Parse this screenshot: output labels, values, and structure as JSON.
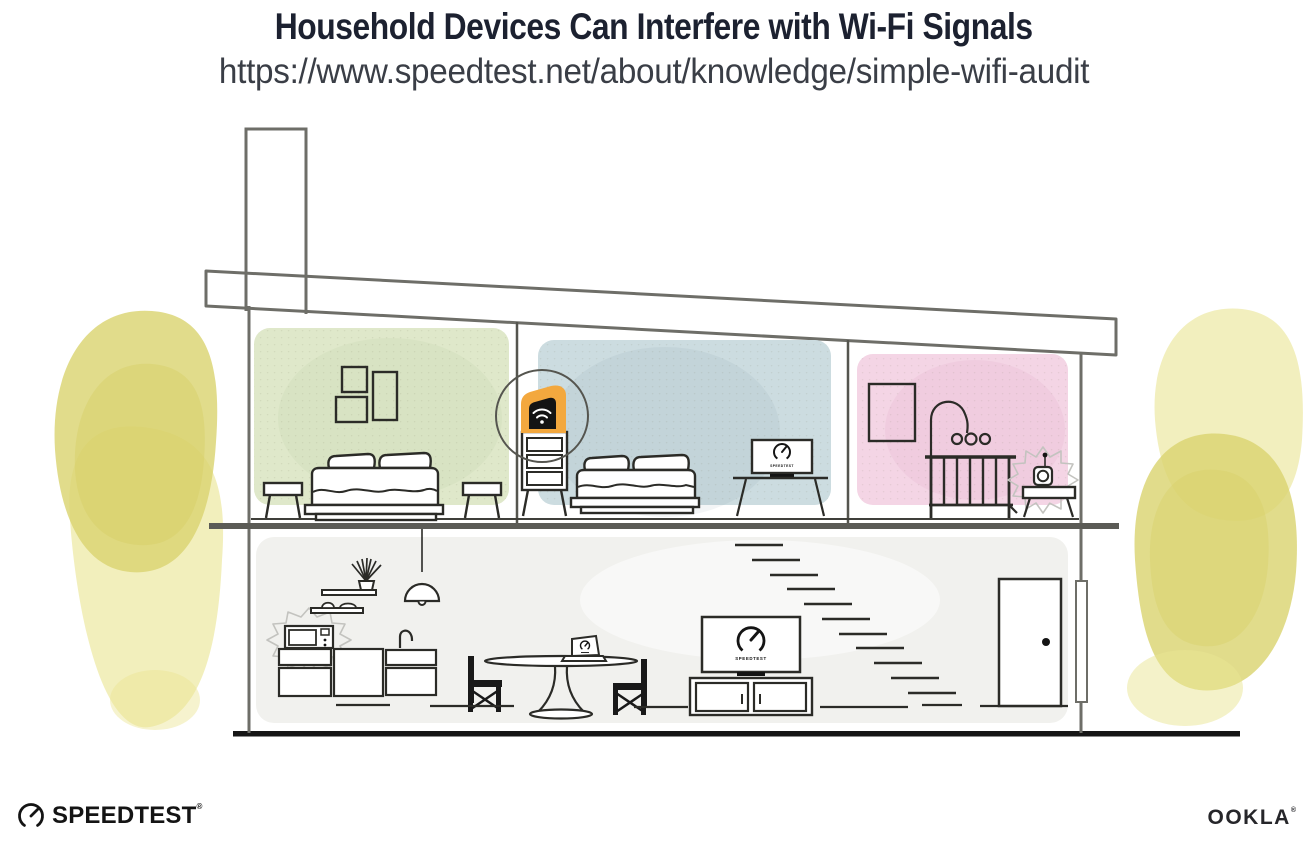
{
  "header": {
    "title": "Household Devices Can Interfere with Wi-Fi Signals",
    "url": "https://www.speedtest.net/about/knowledge/simple-wifi-audit"
  },
  "screens": {
    "tv_label": "SPEEDTEST",
    "monitor_label": "SPEEDTEST"
  },
  "branding": {
    "speedtest_wordmark": "SPEEDTEST",
    "speedtest_reg": "®",
    "ookla_wordmark": "OOKLA",
    "ookla_reg": "®"
  },
  "palette": {
    "accent_orange": "#f3a83e",
    "bedroom_left_wall": "#dfe8ca",
    "bedroom_middle_wall": "#ccdce0",
    "nursery_wall": "#f4d5e5",
    "ground_floor": "#f1f1ee",
    "foliage_yellow": "#dbd472",
    "outline_dark": "#2b2b27",
    "outline_gray": "#6e6e68"
  }
}
